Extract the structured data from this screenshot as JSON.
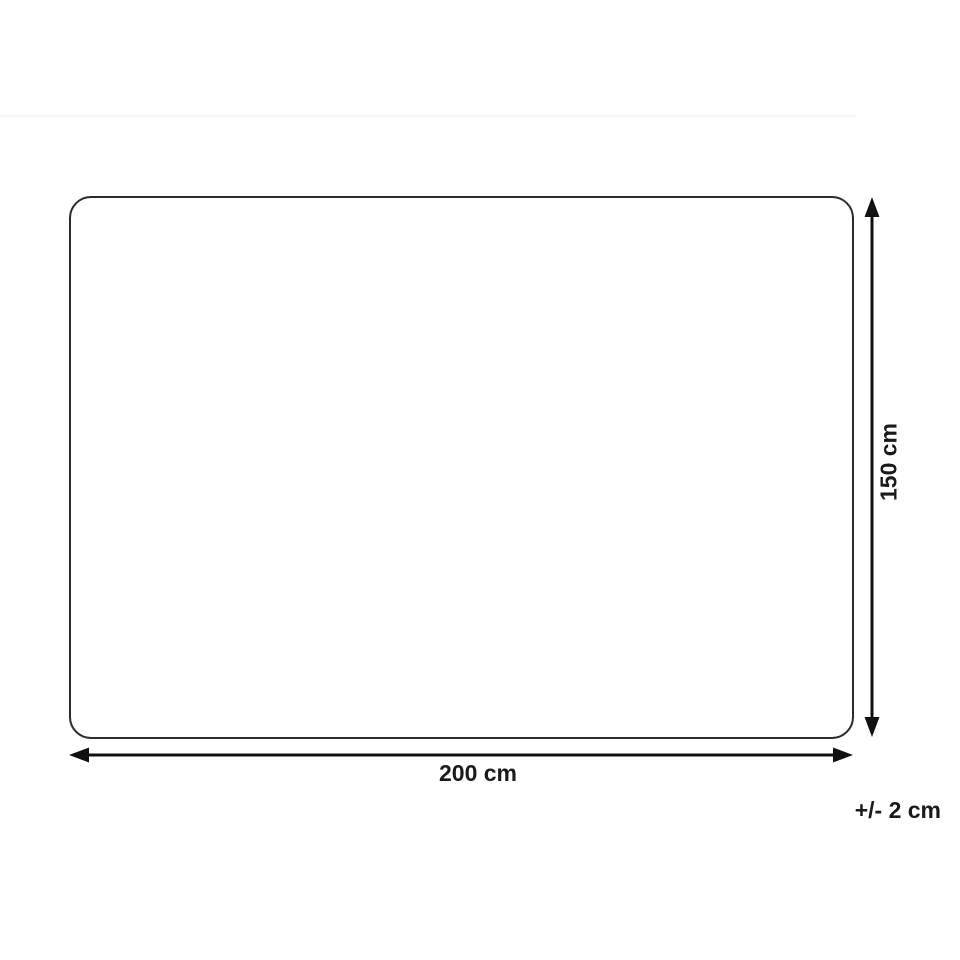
{
  "diagram": {
    "type": "product-dimension-diagram",
    "product_outline": {
      "shape": "rounded-rectangle"
    },
    "width_dimension": {
      "label": "200 cm",
      "arrow": "horizontal-double-headed"
    },
    "height_dimension": {
      "label": "150 cm",
      "arrow": "vertical-double-headed"
    },
    "tolerance": {
      "label": "+/- 2 cm"
    }
  },
  "colors": {
    "background": "#ffffff",
    "outline": "#2b2b2b",
    "arrow": "#111111",
    "text": "#1a1a1a",
    "faint_line": "#f5f5f5"
  }
}
